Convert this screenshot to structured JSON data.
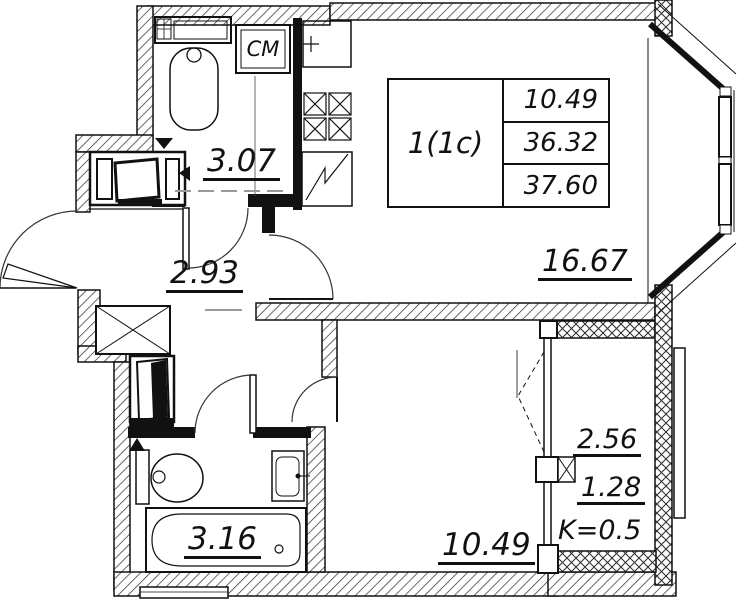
{
  "colors": {
    "line": "#1a1a1a",
    "hatch": "#2a2a2a",
    "dash_gray": "#9a9a9a"
  },
  "unit_table": {
    "unit": "1(1c)",
    "values": [
      "10.49",
      "36.32",
      "37.60"
    ]
  },
  "rooms": {
    "bathroom_top": {
      "area": "3.07"
    },
    "hallway": {
      "area": "2.93"
    },
    "living": {
      "area": "16.67"
    },
    "bathroom_bottom": {
      "area": "3.16"
    },
    "bedroom": {
      "area": "10.49"
    },
    "balcony": {
      "area_full": "2.56",
      "area_reduced": "1.28",
      "coefficient": "K=0.5"
    }
  },
  "fixtures": {
    "washing_machine_label": "СМ"
  }
}
